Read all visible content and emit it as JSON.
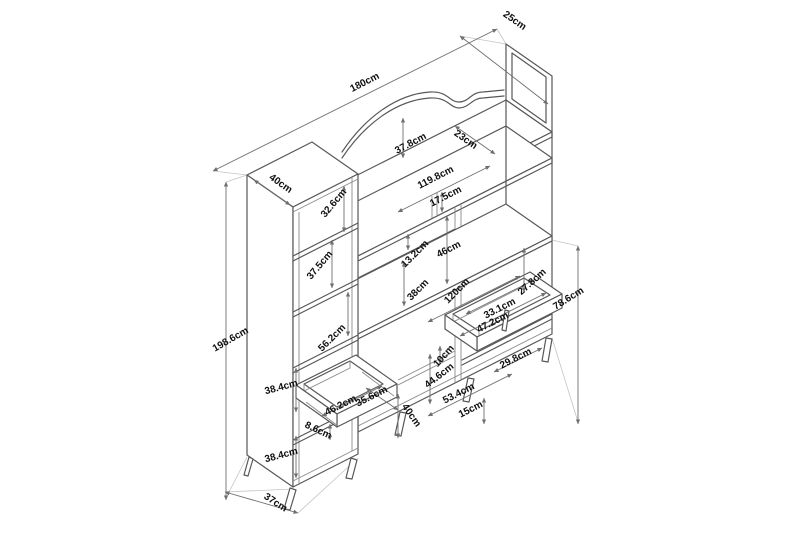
{
  "drawing": {
    "type": "furniture-dimension-diagram",
    "unit": "cm",
    "background_color": "#ffffff",
    "furniture_line_color": "#585858",
    "dimension_line_color": "#6e6e6e",
    "label_color": "#101010",
    "overall": {
      "total_width": "180cm",
      "total_height": "198.6cm",
      "top_depth": "25cm",
      "side_cabinet_depth": "40cm"
    },
    "labels": [
      {
        "text": "25cm",
        "x": 513,
        "y": 23,
        "rot": 35
      },
      {
        "text": "180cm",
        "x": 366,
        "y": 85,
        "rot": -27
      },
      {
        "text": "40cm",
        "x": 279,
        "y": 186,
        "rot": 35
      },
      {
        "text": "37.8cm",
        "x": 412,
        "y": 146,
        "rot": -28
      },
      {
        "text": "23cm",
        "x": 464,
        "y": 142,
        "rot": 35
      },
      {
        "text": "119.8cm",
        "x": 437,
        "y": 180,
        "rot": -27
      },
      {
        "text": "17.5cm",
        "x": 447,
        "y": 199,
        "rot": -27
      },
      {
        "text": "32.6cm",
        "x": 336,
        "y": 205,
        "rot": -50
      },
      {
        "text": "37.5cm",
        "x": 322,
        "y": 267,
        "rot": -50
      },
      {
        "text": "13.2cm",
        "x": 417,
        "y": 256,
        "rot": -45
      },
      {
        "text": "46cm",
        "x": 450,
        "y": 252,
        "rot": -27
      },
      {
        "text": "38cm",
        "x": 420,
        "y": 292,
        "rot": -45
      },
      {
        "text": "120cm",
        "x": 459,
        "y": 293,
        "rot": -45
      },
      {
        "text": "27.8cm",
        "x": 534,
        "y": 284,
        "rot": -42
      },
      {
        "text": "33.1cm",
        "x": 501,
        "y": 311,
        "rot": -27
      },
      {
        "text": "47.2cm",
        "x": 494,
        "y": 325,
        "rot": -27
      },
      {
        "text": "78.6cm",
        "x": 570,
        "y": 301,
        "rot": -32
      },
      {
        "text": "198.6cm",
        "x": 232,
        "y": 342,
        "rot": -30
      },
      {
        "text": "56.2cm",
        "x": 334,
        "y": 340,
        "rot": -45
      },
      {
        "text": "10cm",
        "x": 446,
        "y": 358,
        "rot": -48
      },
      {
        "text": "44.6cm",
        "x": 441,
        "y": 378,
        "rot": -38
      },
      {
        "text": "29.8cm",
        "x": 517,
        "y": 361,
        "rot": -27
      },
      {
        "text": "53.4cm",
        "x": 460,
        "y": 396,
        "rot": -27
      },
      {
        "text": "15cm",
        "x": 472,
        "y": 412,
        "rot": -27
      },
      {
        "text": "46.2cm",
        "x": 342,
        "y": 408,
        "rot": -27
      },
      {
        "text": "35.6cm",
        "x": 373,
        "y": 399,
        "rot": -27
      },
      {
        "text": "8.6cm",
        "x": 317,
        "y": 433,
        "rot": 25
      },
      {
        "text": "38.4cm",
        "x": 282,
        "y": 390,
        "rot": -15
      },
      {
        "text": "38.4cm",
        "x": 282,
        "y": 458,
        "rot": -15
      },
      {
        "text": "40cm",
        "x": 409,
        "y": 417,
        "rot": 55
      },
      {
        "text": "37cm",
        "x": 274,
        "y": 505,
        "rot": 33
      }
    ]
  }
}
